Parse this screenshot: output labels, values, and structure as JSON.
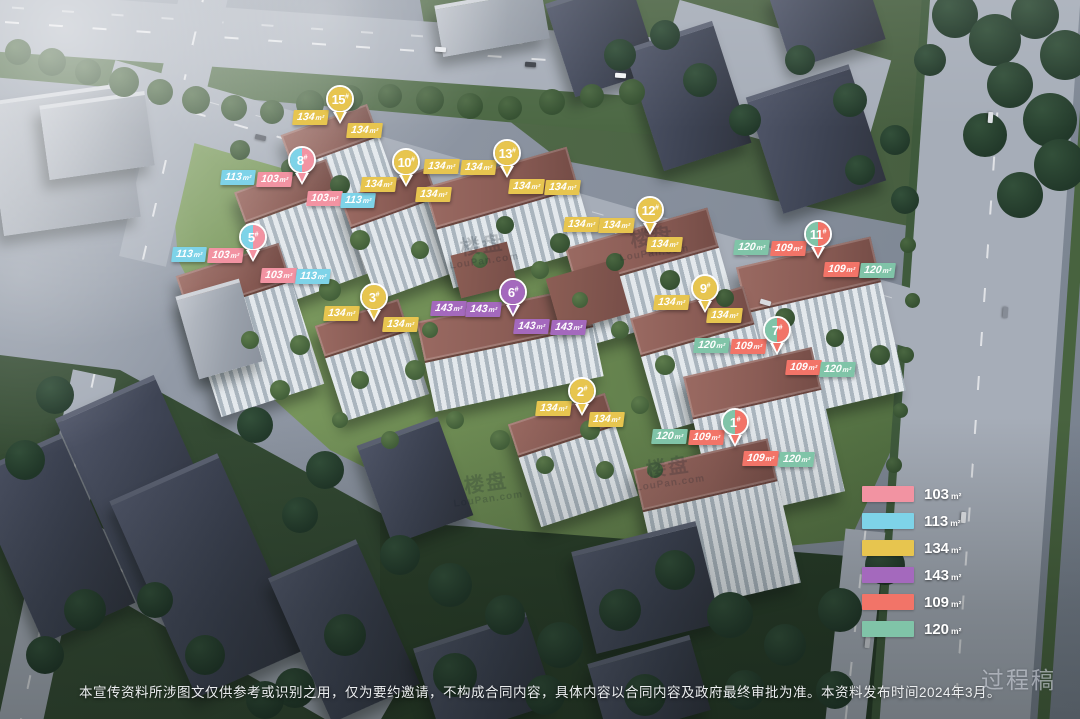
{
  "palette": {
    "103": "#f293a2",
    "113": "#7ed3e8",
    "134": "#e7c54f",
    "143": "#a469bd",
    "109": "#f27468",
    "120": "#80c4a8"
  },
  "legend": {
    "items": [
      {
        "area": "103",
        "unit": "m²",
        "color": "#f293a2"
      },
      {
        "area": "113",
        "unit": "m²",
        "color": "#7ed3e8"
      },
      {
        "area": "134",
        "unit": "m²",
        "color": "#e7c54f"
      },
      {
        "area": "143",
        "unit": "m²",
        "color": "#a469bd"
      },
      {
        "area": "109",
        "unit": "m²",
        "color": "#f27468"
      },
      {
        "area": "120",
        "unit": "m²",
        "color": "#80c4a8"
      }
    ]
  },
  "pins": [
    {
      "num": "15",
      "hash": "#",
      "x": 340,
      "y": 127,
      "areas": [
        "134"
      ]
    },
    {
      "num": "8",
      "hash": "#",
      "x": 302,
      "y": 188,
      "areas": [
        "113",
        "103"
      ]
    },
    {
      "num": "10",
      "hash": "#",
      "x": 406,
      "y": 190,
      "areas": [
        "134"
      ]
    },
    {
      "num": "13",
      "hash": "#",
      "x": 507,
      "y": 181,
      "areas": [
        "134"
      ]
    },
    {
      "num": "12",
      "hash": "#",
      "x": 650,
      "y": 238,
      "areas": [
        "134"
      ]
    },
    {
      "num": "11",
      "hash": "#",
      "x": 818,
      "y": 262,
      "areas": [
        "120",
        "109"
      ]
    },
    {
      "num": "5",
      "hash": "#",
      "x": 253,
      "y": 265,
      "areas": [
        "113",
        "103"
      ]
    },
    {
      "num": "3",
      "hash": "#",
      "x": 374,
      "y": 325,
      "areas": [
        "134"
      ]
    },
    {
      "num": "6",
      "hash": "#",
      "x": 513,
      "y": 320,
      "areas": [
        "143"
      ]
    },
    {
      "num": "9",
      "hash": "#",
      "x": 705,
      "y": 316,
      "areas": [
        "134"
      ]
    },
    {
      "num": "7",
      "hash": "#",
      "x": 777,
      "y": 358,
      "areas": [
        "120",
        "109"
      ]
    },
    {
      "num": "2",
      "hash": "#",
      "x": 582,
      "y": 419,
      "areas": [
        "134"
      ]
    },
    {
      "num": "1",
      "hash": "#",
      "x": 735,
      "y": 450,
      "areas": [
        "120",
        "109"
      ]
    }
  ],
  "tags": [
    {
      "area": "134",
      "unit": "m²",
      "x": 293,
      "y": 110
    },
    {
      "area": "134",
      "unit": "m²",
      "x": 347,
      "y": 123
    },
    {
      "area": "113",
      "unit": "m²",
      "x": 221,
      "y": 170
    },
    {
      "area": "103",
      "unit": "m²",
      "x": 257,
      "y": 172
    },
    {
      "area": "103",
      "unit": "m²",
      "x": 307,
      "y": 191
    },
    {
      "area": "113",
      "unit": "m²",
      "x": 341,
      "y": 193
    },
    {
      "area": "134",
      "unit": "m²",
      "x": 361,
      "y": 177
    },
    {
      "area": "134",
      "unit": "m²",
      "x": 416,
      "y": 187
    },
    {
      "area": "134",
      "unit": "m²",
      "x": 424,
      "y": 159
    },
    {
      "area": "134",
      "unit": "m²",
      "x": 461,
      "y": 160
    },
    {
      "area": "134",
      "unit": "m²",
      "x": 509,
      "y": 179
    },
    {
      "area": "134",
      "unit": "m²",
      "x": 545,
      "y": 180
    },
    {
      "area": "134",
      "unit": "m²",
      "x": 564,
      "y": 217
    },
    {
      "area": "134",
      "unit": "m²",
      "x": 599,
      "y": 218
    },
    {
      "area": "134",
      "unit": "m²",
      "x": 647,
      "y": 237
    },
    {
      "area": "120",
      "unit": "m²",
      "x": 734,
      "y": 240
    },
    {
      "area": "109",
      "unit": "m²",
      "x": 771,
      "y": 241
    },
    {
      "area": "109",
      "unit": "m²",
      "x": 824,
      "y": 262
    },
    {
      "area": "120",
      "unit": "m²",
      "x": 860,
      "y": 263
    },
    {
      "area": "113",
      "unit": "m²",
      "x": 172,
      "y": 247
    },
    {
      "area": "103",
      "unit": "m²",
      "x": 208,
      "y": 248
    },
    {
      "area": "103",
      "unit": "m²",
      "x": 261,
      "y": 268
    },
    {
      "area": "113",
      "unit": "m²",
      "x": 296,
      "y": 269
    },
    {
      "area": "134",
      "unit": "m²",
      "x": 324,
      "y": 306
    },
    {
      "area": "134",
      "unit": "m²",
      "x": 383,
      "y": 317
    },
    {
      "area": "143",
      "unit": "m²",
      "x": 431,
      "y": 301
    },
    {
      "area": "143",
      "unit": "m²",
      "x": 466,
      "y": 302
    },
    {
      "area": "143",
      "unit": "m²",
      "x": 514,
      "y": 319
    },
    {
      "area": "143",
      "unit": "m²",
      "x": 551,
      "y": 320
    },
    {
      "area": "134",
      "unit": "m²",
      "x": 654,
      "y": 295
    },
    {
      "area": "134",
      "unit": "m²",
      "x": 707,
      "y": 308
    },
    {
      "area": "120",
      "unit": "m²",
      "x": 694,
      "y": 338
    },
    {
      "area": "109",
      "unit": "m²",
      "x": 731,
      "y": 339
    },
    {
      "area": "109",
      "unit": "m²",
      "x": 786,
      "y": 360
    },
    {
      "area": "120",
      "unit": "m²",
      "x": 820,
      "y": 362
    },
    {
      "area": "134",
      "unit": "m²",
      "x": 536,
      "y": 401
    },
    {
      "area": "134",
      "unit": "m²",
      "x": 589,
      "y": 412
    },
    {
      "area": "120",
      "unit": "m²",
      "x": 652,
      "y": 429
    },
    {
      "area": "109",
      "unit": "m²",
      "x": 689,
      "y": 430
    },
    {
      "area": "109",
      "unit": "m²",
      "x": 743,
      "y": 451
    },
    {
      "area": "120",
      "unit": "m²",
      "x": 779,
      "y": 452
    }
  ],
  "disclaimer": "本宣传资料所涉图文仅供参考或识别之用，仅为要约邀请，不构成合同内容，具体内容以合同内容及政府最终审批为准。本资料发布时间2024年3月。",
  "draft_watermark": "过程稿",
  "site_watermark": {
    "cn": "楼盘",
    "en": "LouPan.com",
    "positions": [
      {
        "x": 448,
        "y": 236
      },
      {
        "x": 618,
        "y": 228
      },
      {
        "x": 634,
        "y": 458
      },
      {
        "x": 452,
        "y": 474
      }
    ]
  }
}
